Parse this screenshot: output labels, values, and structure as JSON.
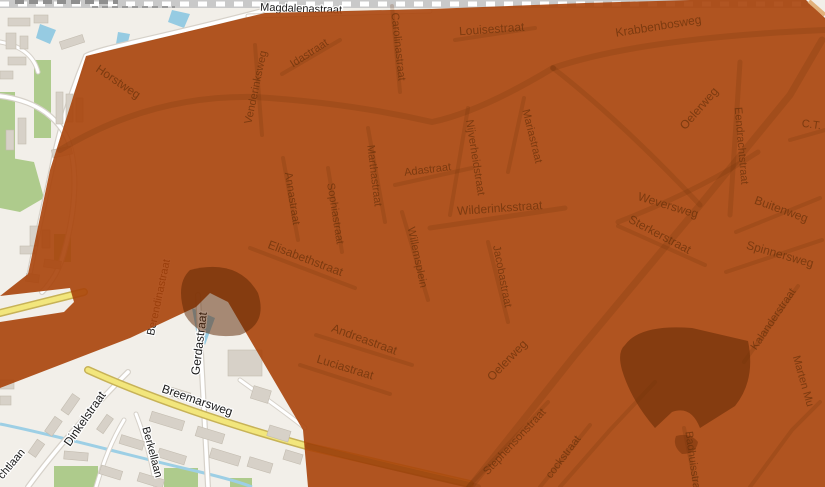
{
  "map": {
    "title": "street-map-with-coverage-overlay",
    "colors": {
      "background": "#f2efe9",
      "overlay": "#a8420a",
      "overlay_rendered": "#b1521c",
      "dark_patch": "#8a4015",
      "water": "#96cbe2",
      "grass": "#aecb8c",
      "building": "#d7d1c8",
      "yellow_road": "#f2e67c",
      "covered_label_text": "#5e2c07",
      "base_label_text": "#1a1a1a"
    },
    "base_labels": [
      {
        "text": "Magdalenastraat",
        "x": 301,
        "y": 12,
        "rot": 2,
        "size": 11
      },
      {
        "text": "Breemarsweg",
        "x": 196,
        "y": 404,
        "rot": 19,
        "size": 12
      },
      {
        "text": "Dinkelstraat",
        "x": 88,
        "y": 421,
        "rot": -55,
        "size": 12
      },
      {
        "text": "Gerdastraat",
        "x": 203,
        "y": 344,
        "rot": -83,
        "size": 12
      },
      {
        "text": "Berendinastraat",
        "x": 162,
        "y": 298,
        "rot": -78,
        "size": 11
      },
      {
        "text": "Berkellaan",
        "x": 149,
        "y": 453,
        "rot": 75,
        "size": 11
      },
      {
        "text": "chtlaan",
        "x": 14,
        "y": 466,
        "rot": -50,
        "size": 11
      }
    ],
    "covered_labels": [
      {
        "text": "Horstweg",
        "x": 116,
        "y": 85,
        "rot": 34,
        "size": 12
      },
      {
        "text": "Venderinksweg",
        "x": 259,
        "y": 88,
        "rot": -78,
        "size": 11
      },
      {
        "text": "Idastraat",
        "x": 311,
        "y": 56,
        "rot": -33,
        "size": 11
      },
      {
        "text": "Carolinastraat",
        "x": 395,
        "y": 47,
        "rot": 84,
        "size": 11
      },
      {
        "text": "Louisestraat",
        "x": 492,
        "y": 33,
        "rot": -4,
        "size": 12
      },
      {
        "text": "Krabbenbosweg",
        "x": 659,
        "y": 30,
        "rot": -9,
        "size": 12
      },
      {
        "text": "Adastraat",
        "x": 428,
        "y": 173,
        "rot": -7,
        "size": 11
      },
      {
        "text": "Marthastraat",
        "x": 371,
        "y": 176,
        "rot": 83,
        "size": 11
      },
      {
        "text": "Annastraat",
        "x": 289,
        "y": 199,
        "rot": 81,
        "size": 11
      },
      {
        "text": "Sophiastraat",
        "x": 332,
        "y": 214,
        "rot": 81,
        "size": 11
      },
      {
        "text": "Nijverheidstraat",
        "x": 472,
        "y": 158,
        "rot": 81,
        "size": 11
      },
      {
        "text": "Mariastraat",
        "x": 529,
        "y": 137,
        "rot": 76,
        "size": 11
      },
      {
        "text": "Wilderinksstraat",
        "x": 500,
        "y": 212,
        "rot": -4,
        "size": 12
      },
      {
        "text": "Willemsplein",
        "x": 414,
        "y": 258,
        "rot": 78,
        "size": 11
      },
      {
        "text": "Jacobastraat",
        "x": 499,
        "y": 277,
        "rot": 79,
        "size": 11
      },
      {
        "text": "Elisabethstraat",
        "x": 304,
        "y": 262,
        "rot": 21,
        "size": 12
      },
      {
        "text": "Andreastraat",
        "x": 363,
        "y": 343,
        "rot": 20,
        "size": 12
      },
      {
        "text": "Luciastraat",
        "x": 344,
        "y": 371,
        "rot": 17,
        "size": 12
      },
      {
        "text": "Oelerweg",
        "x": 510,
        "y": 363,
        "rot": -46,
        "size": 12
      },
      {
        "text": "Oelerweg",
        "x": 702,
        "y": 111,
        "rot": -49,
        "size": 12
      },
      {
        "text": "Stephensonstraat",
        "x": 517,
        "y": 444,
        "rot": -47,
        "size": 11
      },
      {
        "text": "cockstraat",
        "x": 566,
        "y": 459,
        "rot": -53,
        "size": 11
      },
      {
        "text": "Badhuisstraat",
        "x": 690,
        "y": 465,
        "rot": 82,
        "size": 11
      },
      {
        "text": "Eendrachtstraat",
        "x": 738,
        "y": 146,
        "rot": 85,
        "size": 11
      },
      {
        "text": "Weversweg",
        "x": 667,
        "y": 209,
        "rot": 17,
        "size": 12
      },
      {
        "text": "Sterkerstraat",
        "x": 658,
        "y": 238,
        "rot": 28,
        "size": 12
      },
      {
        "text": "Buitenweg",
        "x": 780,
        "y": 213,
        "rot": 20,
        "size": 12
      },
      {
        "text": "Spinnersweg",
        "x": 779,
        "y": 258,
        "rot": 16,
        "size": 12
      },
      {
        "text": "Kalanderstraat",
        "x": 776,
        "y": 321,
        "rot": -56,
        "size": 11
      },
      {
        "text": "Marten Mu",
        "x": 800,
        "y": 382,
        "rot": 74,
        "size": 11
      },
      {
        "text": "C.T.",
        "x": 811,
        "y": 128,
        "rot": 8,
        "size": 11
      }
    ]
  }
}
